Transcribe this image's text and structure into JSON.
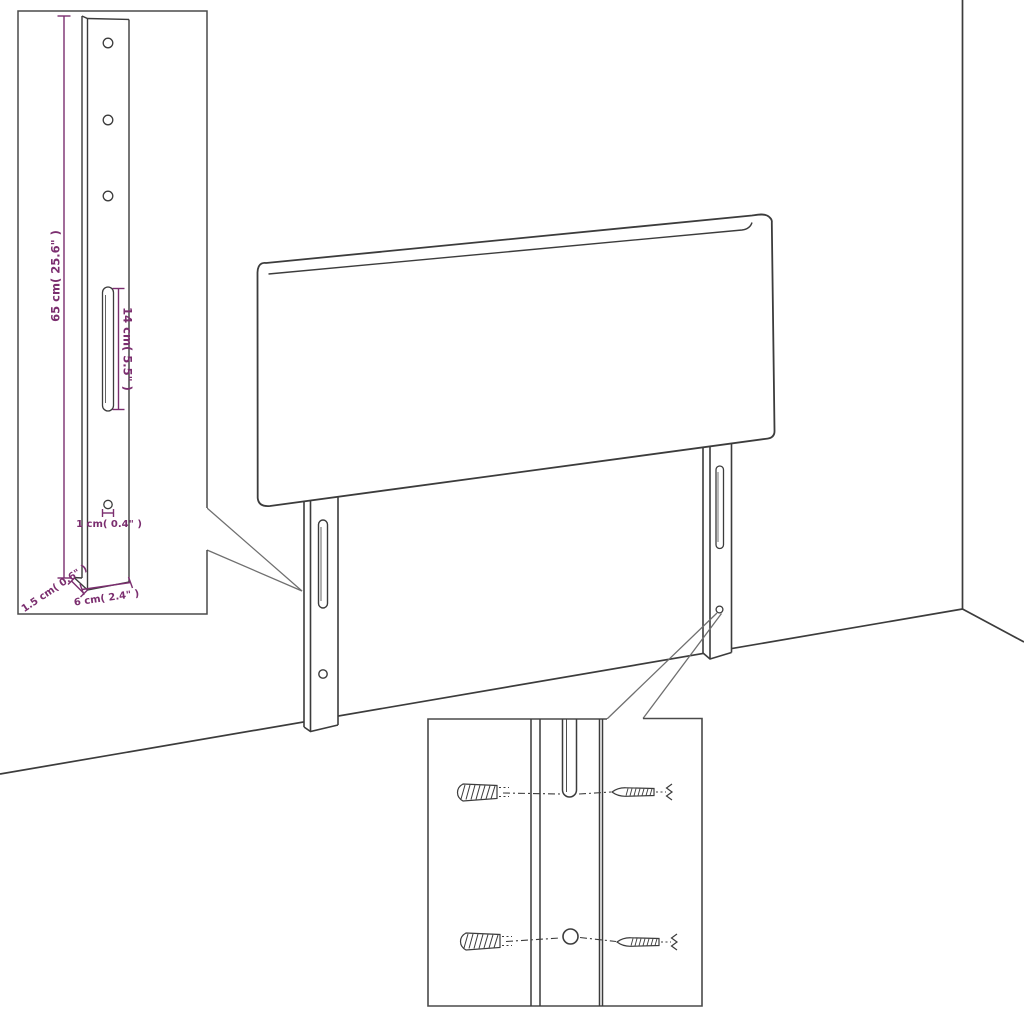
{
  "diagram_type": "furniture-assembly-dimension-diagram",
  "product": "upholstered headboard with two mounting legs",
  "colors": {
    "background": "#ffffff",
    "line_art": "#3c3c3c",
    "inset_border": "#4a4a4a",
    "callout_line": "#6f6f6f",
    "dimension": "#7b2e6f"
  },
  "dims": {
    "height": "65 cm( 25.6\" )",
    "slot": "14 cm( 5.5\" )",
    "hole": "1 cm( 0.4\" )",
    "thickness": "1.5 cm( 0.6\" )",
    "width": "6 cm( 2.4\" )"
  },
  "insets": {
    "leg_detail": "magnified front view of mounting leg with three holes, long slot, small hole",
    "mount_detail": "magnified mounting area with two wall plugs and two screws"
  },
  "scene": {
    "wall_corner": "room corner lines behind headboard",
    "legs": 2,
    "holes_per_leg_visible": 1,
    "slots_per_leg_visible": 1
  }
}
